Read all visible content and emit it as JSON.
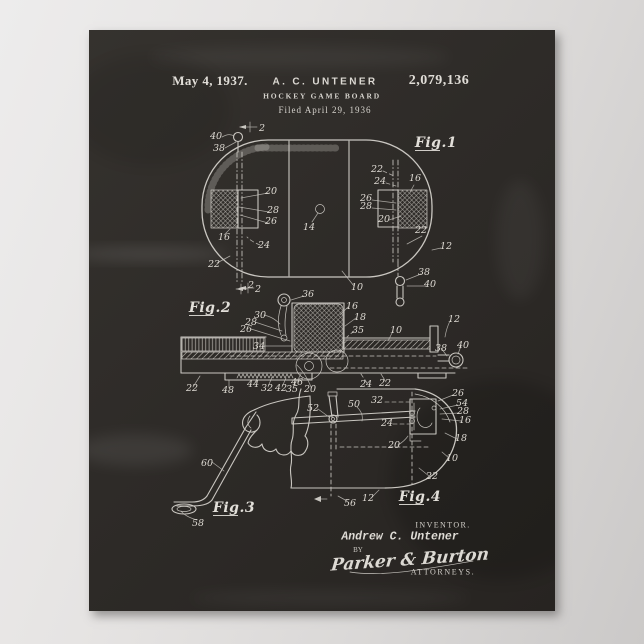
{
  "colors": {
    "page_bg_left": "#edecec",
    "page_bg_right": "#cbc9c8",
    "poster_bg": "#2e2b28",
    "chalk": "#d7d4ce"
  },
  "header": {
    "date": "May 4, 1937.",
    "inventor": "A. C. UNTENER",
    "patent_number": "2,079,136",
    "title": "HOCKEY GAME BOARD",
    "filed": "Filed April 29, 1936"
  },
  "footer": {
    "inventor_caption": "INVENTOR.",
    "inventor_name": "Andrew C. Untener",
    "by": "BY",
    "signature": "Parker & Burton",
    "attorneys": "ATTORNEYS."
  },
  "drawing": {
    "figure_titles": [
      {
        "t": "Fig.1",
        "x": 436,
        "y": 147
      },
      {
        "t": "Fig.2",
        "x": 210,
        "y": 312
      },
      {
        "t": "Fig.3",
        "x": 234,
        "y": 512
      },
      {
        "t": "Fig.4",
        "x": 420,
        "y": 501
      }
    ],
    "fig1_refs": [
      {
        "t": "40",
        "x": 216,
        "y": 139
      },
      {
        "t": "38",
        "x": 219,
        "y": 151
      },
      {
        "t": "2",
        "x": 262,
        "y": 131
      },
      {
        "t": "22",
        "x": 377,
        "y": 172
      },
      {
        "t": "24",
        "x": 380,
        "y": 184
      },
      {
        "t": "16",
        "x": 415,
        "y": 181
      },
      {
        "t": "26",
        "x": 366,
        "y": 201
      },
      {
        "t": "28",
        "x": 366,
        "y": 209
      },
      {
        "t": "20",
        "x": 384,
        "y": 222
      },
      {
        "t": "20",
        "x": 271,
        "y": 194
      },
      {
        "t": "28",
        "x": 273,
        "y": 213
      },
      {
        "t": "26",
        "x": 271,
        "y": 224
      },
      {
        "t": "14",
        "x": 309,
        "y": 230
      },
      {
        "t": "16",
        "x": 224,
        "y": 240
      },
      {
        "t": "24",
        "x": 264,
        "y": 248
      },
      {
        "t": "22",
        "x": 214,
        "y": 267
      },
      {
        "t": "22",
        "x": 421,
        "y": 233
      },
      {
        "t": "12",
        "x": 446,
        "y": 249
      },
      {
        "t": "10",
        "x": 357,
        "y": 290
      },
      {
        "t": "2",
        "x": 258,
        "y": 292
      },
      {
        "t": "38",
        "x": 424,
        "y": 275
      },
      {
        "t": "40",
        "x": 430,
        "y": 287
      },
      {
        "t": "36",
        "x": 308,
        "y": 297
      }
    ],
    "fig2_refs": [
      {
        "t": "30",
        "x": 260,
        "y": 318
      },
      {
        "t": "28",
        "x": 251,
        "y": 325
      },
      {
        "t": "26",
        "x": 246,
        "y": 332
      },
      {
        "t": "34",
        "x": 259,
        "y": 349
      },
      {
        "t": "16",
        "x": 352,
        "y": 309
      },
      {
        "t": "18",
        "x": 360,
        "y": 320
      },
      {
        "t": "35",
        "x": 358,
        "y": 333
      },
      {
        "t": "10",
        "x": 396,
        "y": 333
      },
      {
        "t": "12",
        "x": 454,
        "y": 322
      },
      {
        "t": "38",
        "x": 441,
        "y": 351
      },
      {
        "t": "40",
        "x": 463,
        "y": 348
      },
      {
        "t": "2",
        "x": 251,
        "y": 288
      },
      {
        "t": "22",
        "x": 192,
        "y": 391
      },
      {
        "t": "48",
        "x": 228,
        "y": 393
      },
      {
        "t": "44",
        "x": 253,
        "y": 387
      },
      {
        "t": "32",
        "x": 267,
        "y": 391
      },
      {
        "t": "42",
        "x": 281,
        "y": 391
      },
      {
        "t": "35",
        "x": 292,
        "y": 392
      },
      {
        "t": "46",
        "x": 297,
        "y": 385
      },
      {
        "t": "20",
        "x": 310,
        "y": 392
      },
      {
        "t": "24",
        "x": 366,
        "y": 387
      },
      {
        "t": "22",
        "x": 385,
        "y": 386
      }
    ],
    "fig3_refs": [
      {
        "t": "60",
        "x": 207,
        "y": 466
      },
      {
        "t": "58",
        "x": 198,
        "y": 526
      }
    ],
    "fig4_refs": [
      {
        "t": "52",
        "x": 313,
        "y": 411
      },
      {
        "t": "50",
        "x": 354,
        "y": 407
      },
      {
        "t": "32",
        "x": 377,
        "y": 403
      },
      {
        "t": "24",
        "x": 387,
        "y": 426
      },
      {
        "t": "26",
        "x": 458,
        "y": 396
      },
      {
        "t": "54",
        "x": 462,
        "y": 406
      },
      {
        "t": "28",
        "x": 463,
        "y": 414
      },
      {
        "t": "16",
        "x": 465,
        "y": 423
      },
      {
        "t": "18",
        "x": 461,
        "y": 441
      },
      {
        "t": "20",
        "x": 394,
        "y": 448
      },
      {
        "t": "10",
        "x": 452,
        "y": 461
      },
      {
        "t": "22",
        "x": 432,
        "y": 479
      },
      {
        "t": "12",
        "x": 368,
        "y": 501
      },
      {
        "t": "56",
        "x": 350,
        "y": 506
      }
    ]
  }
}
